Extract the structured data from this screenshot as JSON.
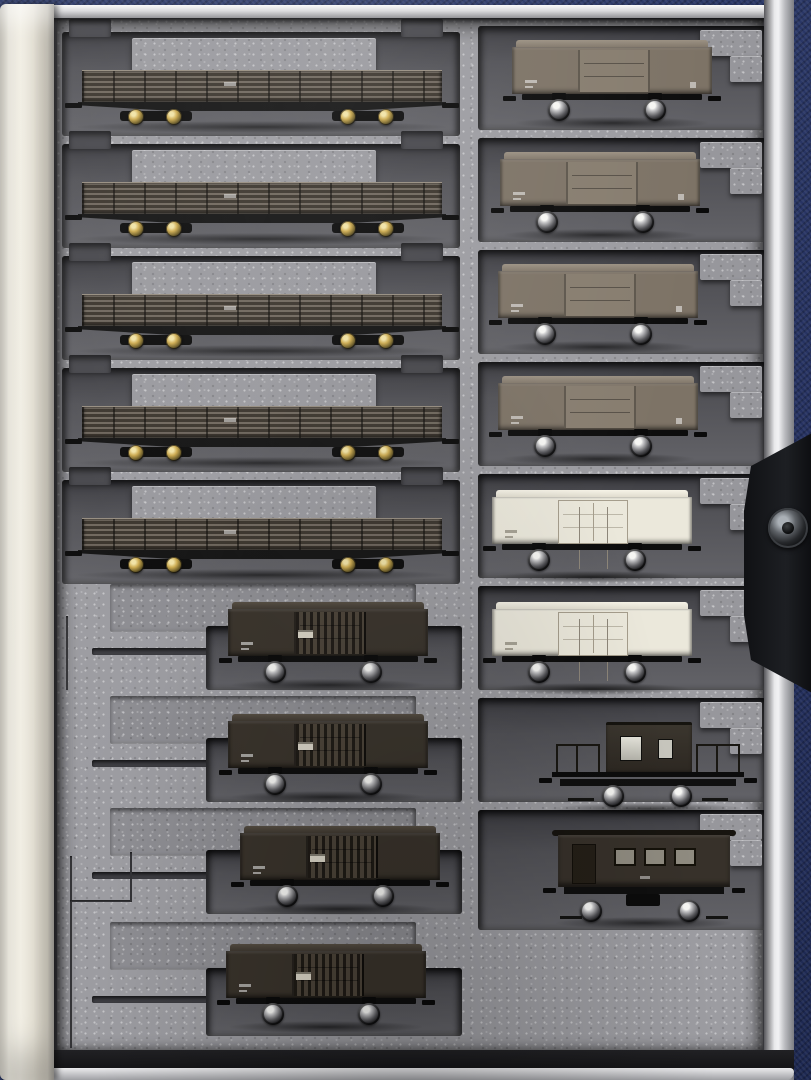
{
  "scene": {
    "title": "N-scale freight car storage case",
    "description": "Photograph looking straight down at an open book-style model-railway carrying case. A grey speckled foam insert with stepped recesses holds seventeen Japanese N-scale freight cars in two columns. The case lies on dark navy woven fabric; a cream vinyl spine runs down the left edge, silver case edges frame the tray, and a black strap with a round metal snap fastener enters from the right.",
    "colors": {
      "fabric_navy": "#273463",
      "foam_surface": "#9c9ca1",
      "foam_recess": "#4b4b50",
      "case_spine_cream": "#efece1",
      "case_edge_silver": "#d9d9db",
      "strap_black": "#15161a",
      "snap_metal": "#7d8287",
      "gondola_body_brown": "#5c554b",
      "boxcar_brown_grey": "#7d7366",
      "boxcar_black": "#39332b",
      "reefer_white": "#ebe8db",
      "wheel_brass": "#cdab50",
      "wheel_silver": "#c4c4c6"
    },
    "case": {
      "spine": "cream vinyl book-case spine, left side",
      "snap_fastener": "round gunmetal snap button on black strap, right side",
      "edges": "bright silver/chrome case edges top, right and bottom"
    },
    "foam_tray": {
      "left_column_rows": 9,
      "right_column_rows": 8,
      "notes": "Long slots (left rows 1-5) have a raised foam island above each car and finger notches at both ends; short slots have stepped staircase cutouts. Left rows 6-9 have shallow ledges, thin trench cuts and knife-slit lines in the unused foam; the area right of the bottom row is solid foam.",
      "markings_note": "All car lettering/number plates are tiny white print, illegible at this resolution"
    }
  },
  "inventory": {
    "summary": {
      "total_cars": 17,
      "bogie_open_gondolas": 5,
      "black_two_axle_boxcars": 4,
      "brown_grey_two_axle_boxcars": 4,
      "white_refrigerator_cars": 2,
      "brake_van_with_platforms": 1,
      "caboose_brake_van": 1
    },
    "cars": [
      {
        "id": "L1",
        "position": "left column, row 1",
        "type": "bogie open gondola (Toki 15000 style)",
        "label": "Dark-brown bogie open gondola car with slatted sides and brass-coloured wheels, left column row 1"
      },
      {
        "id": "L2",
        "position": "left column, row 2",
        "type": "bogie open gondola (Toki 15000 style)",
        "label": "Dark-brown bogie open gondola car with slatted sides and brass-coloured wheels, left column row 2"
      },
      {
        "id": "L3",
        "position": "left column, row 3",
        "type": "bogie open gondola (Toki 15000 style)",
        "label": "Dark-brown bogie open gondola car with slatted sides and brass-coloured wheels, left column row 3"
      },
      {
        "id": "L4",
        "position": "left column, row 4",
        "type": "bogie open gondola (Toki 15000 style)",
        "label": "Dark-brown bogie open gondola car with slatted sides and brass-coloured wheels, left column row 4"
      },
      {
        "id": "L5",
        "position": "left column, row 5",
        "type": "bogie open gondola (Toki 15000 style)",
        "label": "Dark-brown bogie open gondola car with slatted sides and brass-coloured wheels, left column row 5"
      },
      {
        "id": "L6",
        "position": "left column, row 6",
        "type": "two-axle boxcar, black (Wamu style)",
        "label": "Black two-axle boxcar with ribbed sliding door and tiny white number plate, left column row 6"
      },
      {
        "id": "L7",
        "position": "left column, row 7",
        "type": "two-axle boxcar, black (Wamu style)",
        "label": "Black two-axle boxcar with ribbed sliding door and tiny white number plate, left column row 7"
      },
      {
        "id": "L8",
        "position": "left column, row 8",
        "type": "two-axle boxcar, black (Wamu style)",
        "label": "Black two-axle boxcar with ribbed sliding door and tiny white number plate, left column row 8"
      },
      {
        "id": "L9",
        "position": "left column, row 9",
        "type": "two-axle boxcar, black (Wamu style)",
        "label": "Black two-axle boxcar with ribbed sliding door and tiny white number plate, left column row 9 (bottom)"
      },
      {
        "id": "R1",
        "position": "right column, row 1",
        "type": "two-axle boxcar, grey-brown (Wamu 90000 style)",
        "label": "Grey-brown two-axle boxcar with sliding door, right column row 1"
      },
      {
        "id": "R2",
        "position": "right column, row 2",
        "type": "two-axle boxcar, grey-brown (Wamu 90000 style)",
        "label": "Grey-brown two-axle boxcar with sliding door, right column row 2"
      },
      {
        "id": "R3",
        "position": "right column, row 3",
        "type": "two-axle boxcar, grey-brown (Wamu 90000 style)",
        "label": "Grey-brown two-axle boxcar with sliding door, right column row 3"
      },
      {
        "id": "R4",
        "position": "right column, row 4",
        "type": "two-axle boxcar, grey-brown (Wamu 90000 style)",
        "label": "Grey-brown two-axle boxcar with sliding door, right column row 4"
      },
      {
        "id": "R5",
        "position": "right column, row 5",
        "type": "white refrigerator car (Re 12000 style)",
        "label": "White two-axle refrigerator car with outlined double door, right column row 5"
      },
      {
        "id": "R6",
        "position": "right column, row 6",
        "type": "white refrigerator car (Re 12000 style)",
        "label": "White two-axle refrigerator car with outlined double door, right column row 6"
      },
      {
        "id": "R7",
        "position": "right column, row 7",
        "type": "brake van with end platforms (Yo style)",
        "label": "Dark-brown two-axle brake van with central cabin, two windows and open end platforms with railings, right column row 7"
      },
      {
        "id": "R8",
        "position": "right column, row 8",
        "type": "caboose brake van (Wafu/Yo style)",
        "label": "Dark-brown two-axle caboose brake van with end door panel and three side windows, right column row 8"
      }
    ]
  }
}
